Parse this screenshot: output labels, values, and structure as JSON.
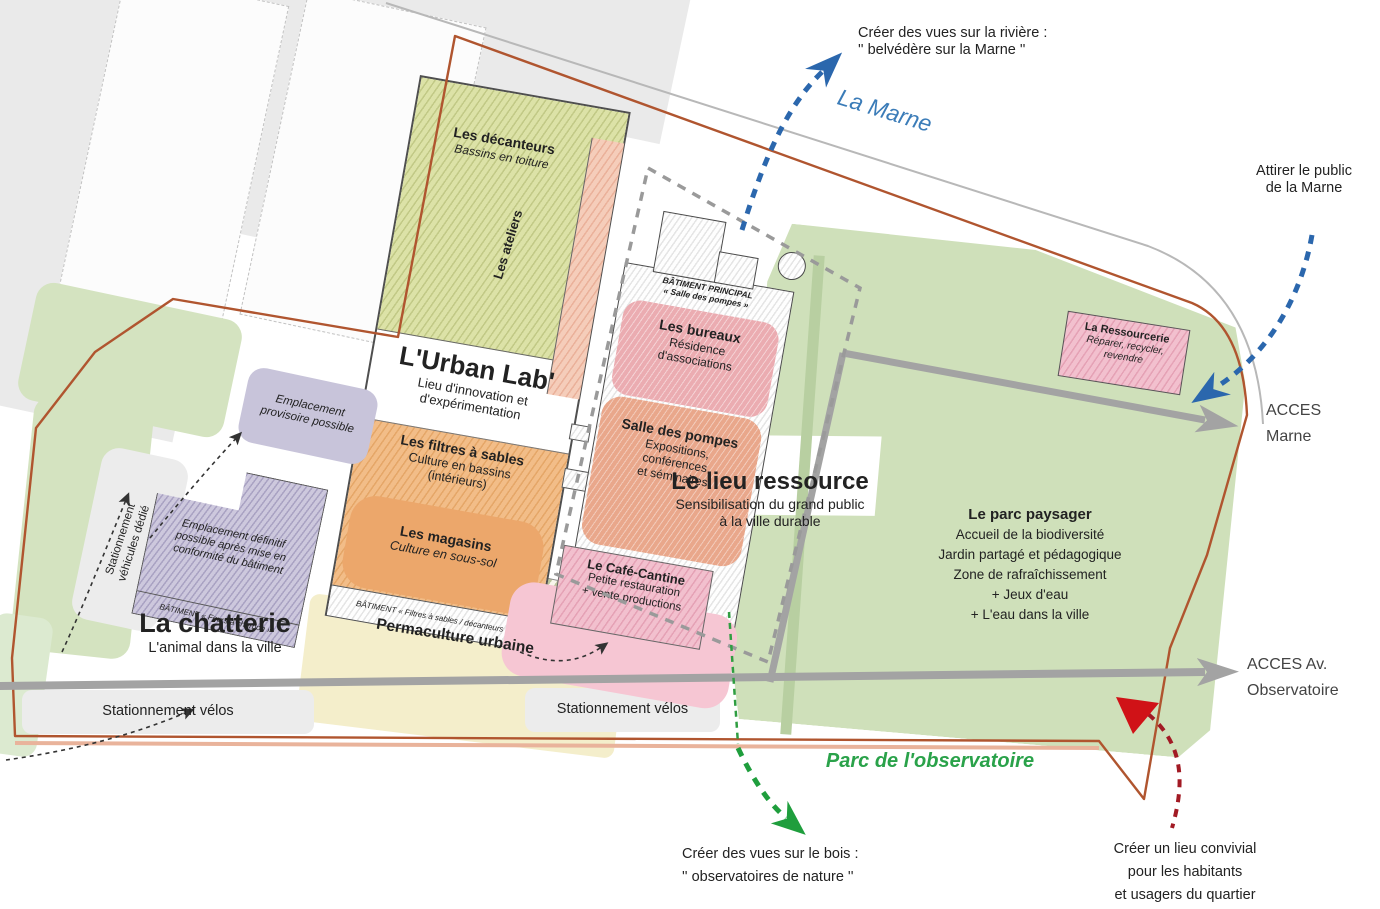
{
  "colors": {
    "boundary": "#b0552f",
    "road": "#a3a3a3",
    "river_text": "#3b7cb8",
    "arrow_blue": "#2b67ad",
    "arrow_green": "#1f9e3d",
    "arrow_red": "#d01217",
    "park_green": "#cfe0ba",
    "parc_obs_text": "#2aa24a"
  },
  "annotations": {
    "riviere": {
      "l1": "Créer des vues sur la rivière :",
      "l2": "'' belvédère sur la Marne ''"
    },
    "la_marne": "La Marne",
    "attirer": {
      "l1": "Attirer le public",
      "l2": "de la Marne"
    },
    "acces_marne": {
      "l1": "ACCES",
      "l2": "Marne"
    },
    "acces_obs": {
      "l1": "ACCES Av.",
      "l2": "Observatoire"
    },
    "parc_obs": "Parc de l'observatoire",
    "bois": {
      "l1": "Créer des vues sur le bois :",
      "l2": "'' observatoires de nature ''"
    },
    "convivial": {
      "l1": "Créer un lieu convivial",
      "l2": "pour les habitants",
      "l3": "et usagers du quartier"
    }
  },
  "zones": {
    "decanteurs": {
      "title": "Les décanteurs",
      "sub": "Bassins en toiture"
    },
    "ateliers": "Les ateliers",
    "urban_lab": {
      "title": "L'Urban Lab'",
      "sub1": "Lieu d'innovation et",
      "sub2": "d'expérimentation"
    },
    "filtres": {
      "title": "Les filtres à sables",
      "sub1": "Culture en bassins",
      "sub2": "(intérieurs)"
    },
    "magasins": {
      "title": "Les magasins",
      "sub": "Culture en sous-sol"
    },
    "batiment_filtres": "BÂTIMENT « Filtres à sables / décanteurs »",
    "batiment_principal": {
      "l1": "BÂTIMENT PRINCIPAL",
      "l2": "« Salle des pompes »"
    },
    "bureaux": {
      "title": "Les bureaux",
      "sub1": "Résidence",
      "sub2": "d'associations"
    },
    "salle_pompes": {
      "title": "Salle des pompes",
      "sub1": "Expositions,",
      "sub2": "conférences",
      "sub3": "et séminaires"
    },
    "lieu_ressource": {
      "title": "Le lieu ressource",
      "sub1": "Sensibilisation du grand public",
      "sub2": "à la ville durable"
    },
    "cafe_cantine": {
      "title": "Le Café-Cantine",
      "sub1": "Petite restauration",
      "sub2": "+ vente productions"
    },
    "parc_paysager": {
      "title": "Le parc paysager",
      "lines": [
        "Accueil de la biodiversité",
        "Jardin partagé et pédagogique",
        "Zone de rafraîchissement",
        "+ Jeux d'eau",
        "+ L'eau dans la ville"
      ]
    },
    "ressourcerie": {
      "title": "La Ressourcerie",
      "sub1": "Réparer, recycler,",
      "sub2": "revendre"
    },
    "permaculture": "Permaculture urbaine",
    "chatterie": {
      "title": "La chatterie",
      "sub": "L'animal dans la ville"
    },
    "emplacement_provisoire": {
      "l1": "Emplacement",
      "l2": "provisoire possible"
    },
    "emplacement_definitif": {
      "l1": "Emplacement définitif",
      "l2": "possible après mise en",
      "l3": "conformité du bâtiment"
    },
    "batiment_fours": "BÂTIMENT « Fours à charbon »",
    "stationnement_vehicules": {
      "l1": "Stationnement",
      "l2": "véhicules dédié"
    },
    "stationnement_velos_left": "Stationnement vélos",
    "stationnement_velos_right": "Stationnement vélos"
  }
}
